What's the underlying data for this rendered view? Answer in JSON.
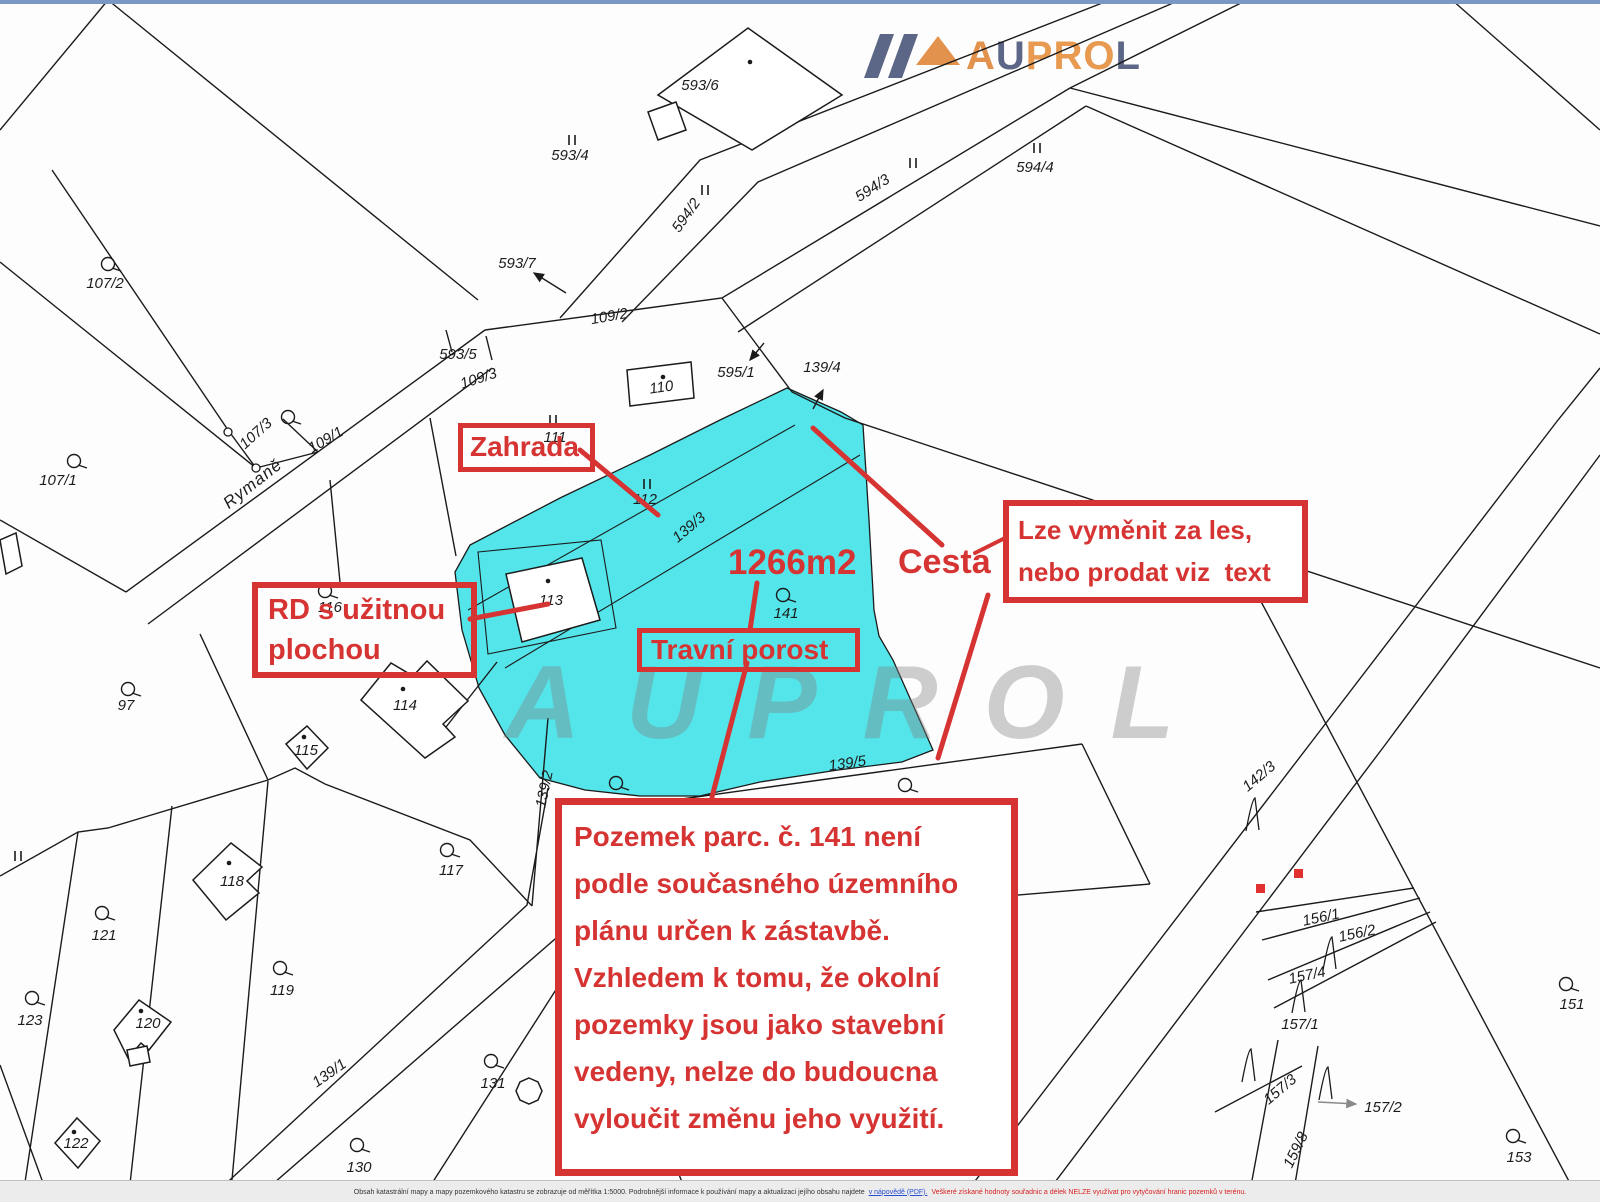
{
  "logo": {
    "name": "AUPROL",
    "letters": [
      {
        "ch": "A",
        "color": "#e2924d"
      },
      {
        "ch": "U",
        "color": "#5c6787"
      },
      {
        "ch": "P",
        "color": "#e89a50"
      },
      {
        "ch": "R",
        "color": "#e89a50"
      },
      {
        "ch": "O",
        "color": "#e89a50"
      },
      {
        "ch": "L",
        "color": "#5c6787"
      }
    ],
    "mark_colors": {
      "bars": "#5c6787",
      "roof": "#e2924d"
    }
  },
  "watermark": {
    "text": "AUPROL",
    "color": "#9a9a9a"
  },
  "colors": {
    "highlight_cyan": "#54e5ea",
    "annotation_red": "#d63333",
    "map_line": "#1b1b1b"
  },
  "annotations": {
    "zahrada": "Zahrada",
    "rd_line1": "RD s užitnou",
    "rd_line2": "plochou",
    "travni": "Travní porost",
    "cesta": "Cesta",
    "area": "1266m2",
    "lze_line1": "Lze vyměnit za les,",
    "lze_line2": "nebo prodat viz  text",
    "main_note_lines": [
      "Pozemek parc. č. 141 není",
      "podle současného územního",
      "plánu určen k zástavbě.",
      "Vzhledem k tomu, že okolní",
      "pozemky jsou jako stavební",
      "vedeny, nelze do budoucna",
      "vyloučit změnu jeho využití."
    ]
  },
  "map": {
    "highlighted_parcel": "141",
    "labels": [
      {
        "t": "107/2",
        "x": 105,
        "y": 288
      },
      {
        "t": "107/1",
        "x": 58,
        "y": 485
      },
      {
        "t": "107/3",
        "x": 259,
        "y": 437,
        "r": -42
      },
      {
        "t": "Rymaně",
        "x": 256,
        "y": 488,
        "r": -38,
        "s": "street"
      },
      {
        "t": "109/1",
        "x": 328,
        "y": 444,
        "r": -30
      },
      {
        "t": "109/3",
        "x": 480,
        "y": 383,
        "r": -18
      },
      {
        "t": "109/2",
        "x": 610,
        "y": 321,
        "r": -10
      },
      {
        "t": "593/5",
        "x": 458,
        "y": 359
      },
      {
        "t": "593/4",
        "x": 570,
        "y": 160
      },
      {
        "t": "593/6",
        "x": 700,
        "y": 90
      },
      {
        "t": "593/7",
        "x": 517,
        "y": 268
      },
      {
        "t": "594/2",
        "x": 690,
        "y": 218,
        "r": -55
      },
      {
        "t": "594/3",
        "x": 875,
        "y": 192,
        "r": -33
      },
      {
        "t": "594/4",
        "x": 1035,
        "y": 172
      },
      {
        "t": "110",
        "x": 662,
        "y": 392,
        "r": -8
      },
      {
        "t": "595/1",
        "x": 736,
        "y": 377
      },
      {
        "t": "139/4",
        "x": 822,
        "y": 372
      },
      {
        "t": "111",
        "x": 555,
        "y": 442
      },
      {
        "t": "112",
        "x": 645,
        "y": 504
      },
      {
        "t": "139/3",
        "x": 692,
        "y": 531,
        "r": -40
      },
      {
        "t": "113",
        "x": 551,
        "y": 605
      },
      {
        "t": "116",
        "x": 330,
        "y": 612
      },
      {
        "t": "141",
        "x": 786,
        "y": 618
      },
      {
        "t": "97",
        "x": 126,
        "y": 710
      },
      {
        "t": "114",
        "x": 405,
        "y": 710
      },
      {
        "t": "115",
        "x": 306,
        "y": 755
      },
      {
        "t": "117",
        "x": 451,
        "y": 875
      },
      {
        "t": "118",
        "x": 232,
        "y": 886
      },
      {
        "t": "121",
        "x": 104,
        "y": 940
      },
      {
        "t": "119",
        "x": 282,
        "y": 995
      },
      {
        "t": "123",
        "x": 30,
        "y": 1025
      },
      {
        "t": "120",
        "x": 148,
        "y": 1028
      },
      {
        "t": "122",
        "x": 76,
        "y": 1148
      },
      {
        "t": "131",
        "x": 493,
        "y": 1088
      },
      {
        "t": "130",
        "x": 359,
        "y": 1172
      },
      {
        "t": "139/1",
        "x": 332,
        "y": 1077,
        "r": -35
      },
      {
        "t": "139/2",
        "x": 549,
        "y": 790,
        "r": -78
      },
      {
        "t": "139/5",
        "x": 848,
        "y": 768,
        "r": -8
      },
      {
        "t": "142/3",
        "x": 1262,
        "y": 780,
        "r": -40
      },
      {
        "t": "156/1",
        "x": 1322,
        "y": 922,
        "r": -12
      },
      {
        "t": "156/2",
        "x": 1358,
        "y": 938,
        "r": -12
      },
      {
        "t": "157/4",
        "x": 1308,
        "y": 980,
        "r": -12
      },
      {
        "t": "157/1",
        "x": 1300,
        "y": 1029
      },
      {
        "t": "157/3",
        "x": 1283,
        "y": 1093,
        "r": -40
      },
      {
        "t": "157/2",
        "x": 1383,
        "y": 1112
      },
      {
        "t": "159/8",
        "x": 1300,
        "y": 1152,
        "r": -64
      },
      {
        "t": "151",
        "x": 1572,
        "y": 1009
      },
      {
        "t": "153",
        "x": 1519,
        "y": 1162
      }
    ]
  },
  "footer": {
    "text_black": "Obsah katastrální mapy a mapy pozemkového katastru se zobrazuje od měřítka 1:5000. Podrobnější informace k používání mapy a aktualizaci jejího obsahu najdete",
    "link": "v nápovědě (PDF).",
    "text_red": "Veškeré získané hodnoty souřadnic a délek NELZE využívat pro vytyčování hranic pozemků v terénu."
  }
}
